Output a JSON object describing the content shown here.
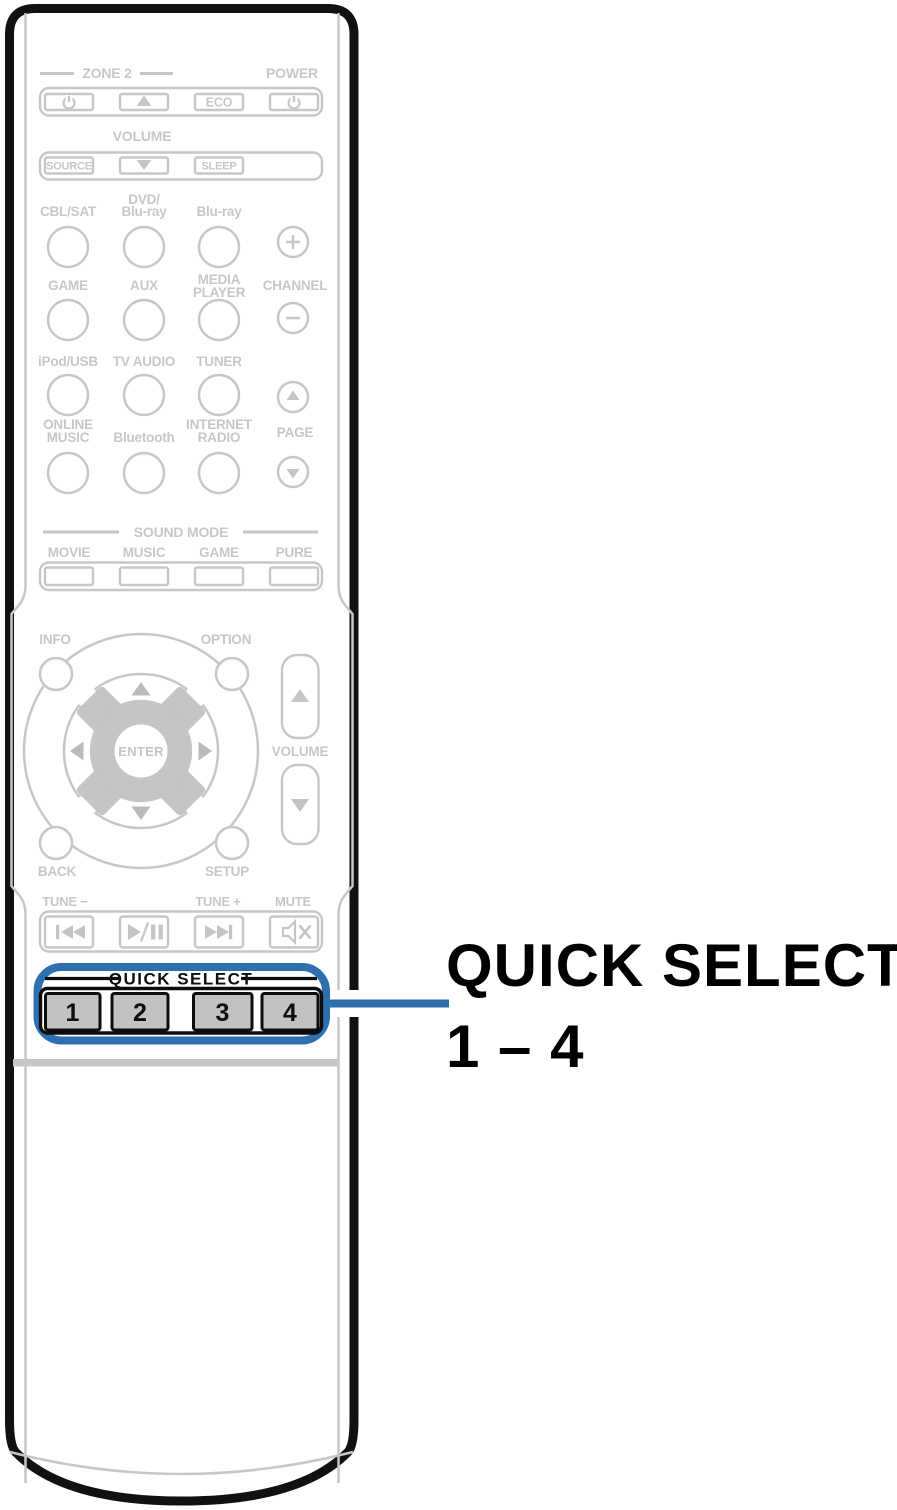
{
  "colors": {
    "accent": "#2e6fb0",
    "gray": "#c6c7c9",
    "ink": "#0d0d0d",
    "button_gray": "#c2c2c2"
  },
  "callout": {
    "line1": "QUICK SELECT",
    "line2": "1 – 4"
  },
  "remote": {
    "top": {
      "zone2": "ZONE 2",
      "power": "POWER",
      "volume": "VOLUME",
      "eco": "ECO",
      "source": "SOURCE",
      "sleep": "SLEEP"
    },
    "sources": {
      "cbl_sat": "CBL/SAT",
      "dvd_line1": "DVD/",
      "dvd_line2": "Blu-ray",
      "bluray": "Blu-ray",
      "game": "GAME",
      "aux": "AUX",
      "media_line1": "MEDIA",
      "media_line2": "PLAYER",
      "ipod_usb": "iPod/USB",
      "tv_audio": "TV AUDIO",
      "tuner": "TUNER",
      "online_line1": "ONLINE",
      "online_line2": "MUSIC",
      "bluetooth": "Bluetooth",
      "internet_line1": "INTERNET",
      "internet_line2": "RADIO"
    },
    "channel": {
      "label": "CHANNEL"
    },
    "page": {
      "label": "PAGE"
    },
    "sound_mode": {
      "label": "SOUND MODE",
      "buttons": [
        "MOVIE",
        "MUSIC",
        "GAME",
        "PURE"
      ]
    },
    "nav": {
      "info": "INFO",
      "option": "OPTION",
      "back": "BACK",
      "setup": "SETUP",
      "enter": "ENTER",
      "volume": "VOLUME"
    },
    "transport": {
      "tune_minus": "TUNE −",
      "tune_plus": "TUNE +",
      "mute": "MUTE"
    },
    "quick_select": {
      "label": "QUICK SELECT",
      "buttons": [
        "1",
        "2",
        "3",
        "4"
      ]
    }
  }
}
